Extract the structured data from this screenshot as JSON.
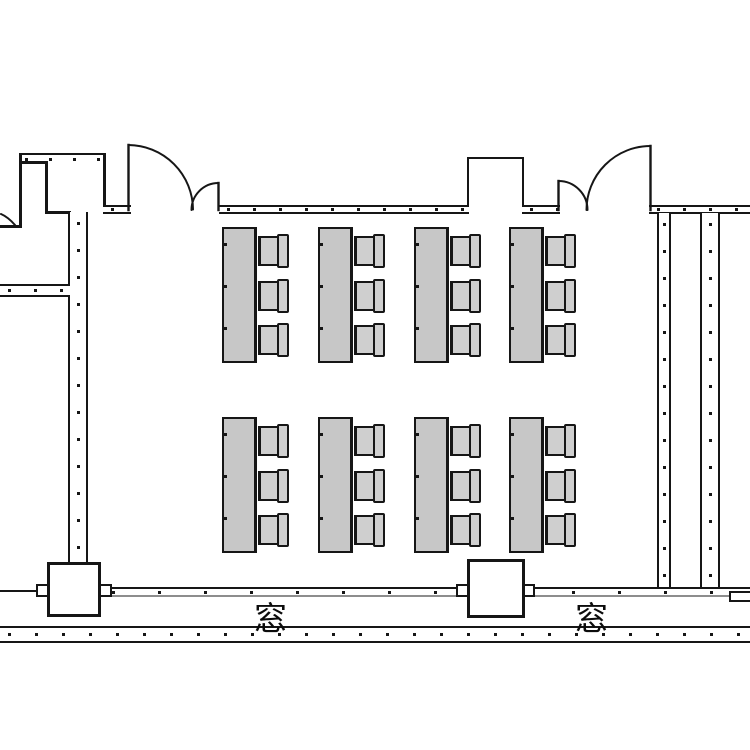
{
  "plan": {
    "type": "classroom-floor-plan",
    "labels": {
      "window_left": "窓",
      "window_right": "窓"
    },
    "colors": {
      "line": "#161616",
      "desk_fill": "#c7c7c7",
      "chair_fill": "#cfcfcf",
      "background": "#ffffff"
    },
    "furniture": {
      "desk_columns_x": [
        222,
        318,
        414,
        509
      ],
      "desk_rows_y": [
        227,
        417
      ],
      "desk_size": {
        "w": 35,
        "h": 136
      },
      "chair": {
        "w": 31,
        "h": 34,
        "offsets_y": [
          7,
          52,
          96
        ]
      },
      "counts": {
        "desks": 8,
        "chairs_per_desk": 3,
        "chairs_total": 24
      }
    }
  }
}
